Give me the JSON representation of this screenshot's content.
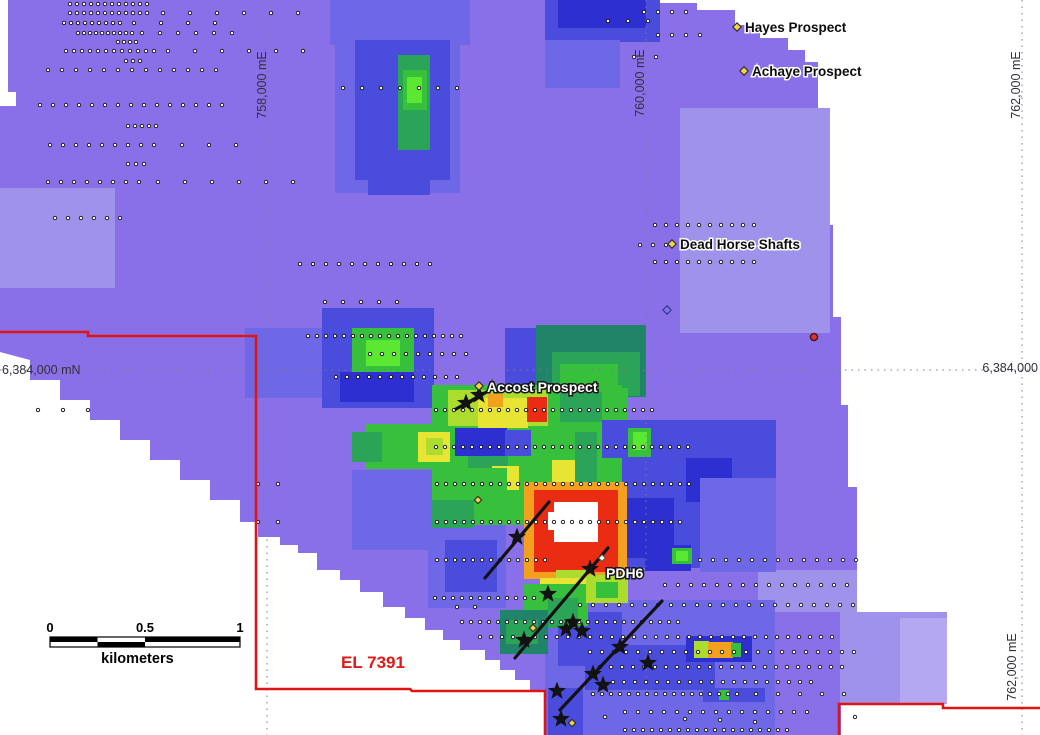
{
  "map": {
    "palette": {
      "base": "#8a70e8",
      "p1": "#9f92ea",
      "p2": "#b3a8f1",
      "lb": "#6f68e6",
      "b": "#4a4cdc",
      "db": "#2d2fd0",
      "nb": "#2324bc",
      "tl": "#1f8468",
      "tg": "#2ba458",
      "g": "#36c03c",
      "bg": "#5ce832",
      "yg": "#abdc2e",
      "y": "#e8e434",
      "o": "#f2a01e",
      "ro": "#f2641a",
      "r": "#ea2d12",
      "w": "#ffffff",
      "boundary": "#e11414",
      "gridline": "#7a7a8a",
      "star": "#121212",
      "marker_yellow": "#f2d545",
      "marker_outline": "#2a2a2a"
    },
    "surface_outline": "0,0 640,0 640,3 697,3 697,10 735,10 735,25 760,25 760,38 788,38 788,50 805,50 805,62 818,62 818,137 823,137 823,225 833,225 833,317 841,317 841,405 848,405 848,487 857,487 857,612 947,612 947,703 841,703 841,735 595,735 583,735 583,723 570,723 570,712 558,712 558,700 545,700 545,690 530,690 530,680 515,680 515,670 500,670 500,660 485,660 485,650 460,650 460,640 443,640 443,630 425,630 425,618 405,618 405,607 383,607 383,592 360,592 360,580 340,580 340,570 317,570 317,553 298,553 298,545 280,545 280,537 258,537 258,522 240,522 240,500 210,500 210,480 180,480 180,460 150,460 150,440 120,440 120,420 90,420 90,400 60,400 60,380 30,380 30,360 0,352",
    "heat_cells": [
      [
        0,
        0,
        8,
        98,
        "w"
      ],
      [
        0,
        92,
        16,
        14,
        "w"
      ],
      [
        680,
        108,
        150,
        225,
        "p1"
      ],
      [
        0,
        188,
        115,
        100,
        "p1"
      ],
      [
        758,
        570,
        99,
        42,
        "p1"
      ],
      [
        840,
        612,
        107,
        92,
        "p1"
      ],
      [
        900,
        618,
        47,
        86,
        "p2"
      ],
      [
        330,
        0,
        140,
        45,
        "lb"
      ],
      [
        335,
        25,
        125,
        168,
        "lb"
      ],
      [
        355,
        40,
        95,
        140,
        "b"
      ],
      [
        545,
        0,
        115,
        42,
        "b"
      ],
      [
        558,
        0,
        88,
        28,
        "db"
      ],
      [
        545,
        40,
        75,
        48,
        "lb"
      ],
      [
        398,
        55,
        32,
        118,
        "tg"
      ],
      [
        403,
        70,
        24,
        40,
        "g"
      ],
      [
        407,
        77,
        15,
        26,
        "bg"
      ],
      [
        368,
        150,
        62,
        45,
        "b"
      ],
      [
        245,
        328,
        85,
        70,
        "lb"
      ],
      [
        322,
        308,
        112,
        100,
        "b"
      ],
      [
        352,
        328,
        62,
        58,
        "g"
      ],
      [
        366,
        340,
        34,
        26,
        "bg"
      ],
      [
        340,
        372,
        74,
        30,
        "db"
      ],
      [
        505,
        328,
        48,
        64,
        "b"
      ],
      [
        536,
        325,
        110,
        72,
        "tl"
      ],
      [
        552,
        352,
        88,
        44,
        "tg"
      ],
      [
        560,
        364,
        58,
        26,
        "g"
      ],
      [
        596,
        420,
        180,
        148,
        "b"
      ],
      [
        610,
        498,
        64,
        60,
        "db"
      ],
      [
        686,
        458,
        46,
        44,
        "db"
      ],
      [
        645,
        545,
        46,
        26,
        "db"
      ],
      [
        700,
        478,
        76,
        94,
        "lb"
      ],
      [
        545,
        600,
        230,
        135,
        "lb"
      ],
      [
        558,
        612,
        64,
        54,
        "b"
      ],
      [
        585,
        645,
        130,
        45,
        "b"
      ],
      [
        548,
        688,
        35,
        47,
        "b"
      ],
      [
        686,
        636,
        66,
        26,
        "db"
      ],
      [
        703,
        688,
        62,
        14,
        "b"
      ],
      [
        352,
        470,
        80,
        80,
        "lb"
      ],
      [
        428,
        520,
        78,
        88,
        "lb"
      ],
      [
        445,
        540,
        52,
        52,
        "b"
      ],
      [
        432,
        385,
        190,
        140,
        "g"
      ],
      [
        448,
        390,
        100,
        36,
        "yg"
      ],
      [
        600,
        388,
        28,
        32,
        "g"
      ],
      [
        560,
        392,
        42,
        30,
        "tg"
      ],
      [
        478,
        398,
        50,
        30,
        "y"
      ],
      [
        488,
        394,
        15,
        13,
        "o"
      ],
      [
        527,
        397,
        20,
        25,
        "r"
      ],
      [
        365,
        424,
        80,
        45,
        "g"
      ],
      [
        352,
        432,
        30,
        30,
        "tg"
      ],
      [
        418,
        432,
        32,
        30,
        "y"
      ],
      [
        426,
        438,
        17,
        17,
        "yg"
      ],
      [
        455,
        428,
        52,
        28,
        "db"
      ],
      [
        505,
        430,
        26,
        26,
        "b"
      ],
      [
        468,
        456,
        40,
        20,
        "tg"
      ],
      [
        492,
        466,
        27,
        27,
        "y"
      ],
      [
        552,
        460,
        28,
        34,
        "y"
      ],
      [
        575,
        432,
        22,
        56,
        "tg"
      ],
      [
        602,
        420,
        22,
        38,
        "b"
      ],
      [
        628,
        428,
        23,
        29,
        "g"
      ],
      [
        633,
        432,
        14,
        18,
        "bg"
      ],
      [
        445,
        468,
        62,
        56,
        "g"
      ],
      [
        432,
        500,
        42,
        28,
        "tg"
      ],
      [
        500,
        490,
        62,
        32,
        "g"
      ],
      [
        672,
        548,
        20,
        16,
        "g"
      ],
      [
        676,
        551,
        12,
        10,
        "bg"
      ],
      [
        524,
        482,
        103,
        97,
        "o"
      ],
      [
        534,
        490,
        84,
        82,
        "r"
      ],
      [
        554,
        502,
        44,
        40,
        "w"
      ],
      [
        548,
        512,
        8,
        18,
        "w"
      ],
      [
        556,
        570,
        32,
        12,
        "yg"
      ],
      [
        540,
        578,
        52,
        16,
        "y"
      ],
      [
        524,
        584,
        64,
        42,
        "g"
      ],
      [
        586,
        575,
        42,
        28,
        "yg"
      ],
      [
        596,
        582,
        22,
        16,
        "g"
      ],
      [
        548,
        598,
        30,
        30,
        "tg"
      ],
      [
        500,
        610,
        48,
        44,
        "tl"
      ],
      [
        506,
        620,
        32,
        24,
        "tg"
      ],
      [
        694,
        641,
        15,
        17,
        "yg"
      ],
      [
        708,
        642,
        25,
        16,
        "o"
      ],
      [
        731,
        643,
        10,
        14,
        "g"
      ],
      [
        719,
        690,
        10,
        10,
        "g"
      ]
    ],
    "gridlines": {
      "verticals": [
        267,
        646,
        1022
      ],
      "horizontal": 370
    },
    "sample_rows": [
      {
        "y": 4,
        "segs": [
          [
            70,
            150,
            7
          ]
        ]
      },
      {
        "y": 13,
        "segs": [
          [
            70,
            150,
            7
          ],
          [
            163,
            312,
            27
          ]
        ]
      },
      {
        "y": 12,
        "segs": [
          [
            644,
            688,
            14
          ]
        ]
      },
      {
        "y": 23,
        "segs": [
          [
            64,
            122,
            7
          ],
          [
            134,
            218,
            27
          ]
        ]
      },
      {
        "y": 21,
        "segs": [
          [
            608,
            650,
            20
          ]
        ]
      },
      {
        "y": 33,
        "segs": [
          [
            78,
            132,
            6
          ],
          [
            142,
            232,
            18
          ]
        ]
      },
      {
        "y": 35,
        "segs": [
          [
            658,
            700,
            14
          ]
        ]
      },
      {
        "y": 42,
        "segs": [
          [
            118,
            139,
            6
          ]
        ]
      },
      {
        "y": 51,
        "segs": [
          [
            66,
            158,
            8
          ],
          [
            168,
            312,
            27
          ]
        ]
      },
      {
        "y": 57,
        "segs": [
          [
            634,
            658,
            22
          ]
        ]
      },
      {
        "y": 61,
        "segs": [
          [
            126,
            141,
            7
          ]
        ]
      },
      {
        "y": 70,
        "segs": [
          [
            48,
            217,
            14
          ]
        ]
      },
      {
        "y": 88,
        "segs": [
          [
            343,
            458,
            19
          ]
        ]
      },
      {
        "y": 105,
        "segs": [
          [
            40,
            224,
            13
          ]
        ]
      },
      {
        "y": 126,
        "segs": [
          [
            128,
            162,
            7
          ]
        ]
      },
      {
        "y": 145,
        "segs": [
          [
            50,
            163,
            13
          ],
          [
            182,
            262,
            27
          ]
        ]
      },
      {
        "y": 164,
        "segs": [
          [
            128,
            145,
            8
          ]
        ]
      },
      {
        "y": 182,
        "segs": [
          [
            48,
            146,
            13
          ],
          [
            158,
            310,
            27
          ]
        ]
      },
      {
        "y": 218,
        "segs": [
          [
            55,
            125,
            13
          ]
        ]
      },
      {
        "y": 225,
        "segs": [
          [
            655,
            757,
            11
          ]
        ]
      },
      {
        "y": 245,
        "segs": [
          [
            640,
            666,
            13
          ]
        ]
      },
      {
        "y": 262,
        "segs": [
          [
            655,
            762,
            11
          ]
        ]
      },
      {
        "y": 264,
        "segs": [
          [
            300,
            436,
            13
          ]
        ]
      },
      {
        "y": 302,
        "segs": [
          [
            325,
            397,
            18
          ]
        ]
      },
      {
        "y": 336,
        "segs": [
          [
            308,
            462,
            9
          ]
        ]
      },
      {
        "y": 354,
        "segs": [
          [
            370,
            470,
            12
          ]
        ]
      },
      {
        "y": 377,
        "segs": [
          [
            336,
            458,
            11
          ]
        ]
      },
      {
        "y": 410,
        "segs": [
          [
            38,
            112,
            25
          ],
          [
            436,
            660,
            9
          ]
        ]
      },
      {
        "y": 447,
        "segs": [
          [
            436,
            690,
            9
          ]
        ]
      },
      {
        "y": 484,
        "segs": [
          [
            258,
            282,
            20
          ],
          [
            437,
            690,
            9
          ]
        ]
      },
      {
        "y": 522,
        "segs": [
          [
            258,
            282,
            20
          ],
          [
            437,
            688,
            9
          ]
        ]
      },
      {
        "y": 560,
        "segs": [
          [
            437,
            545,
            9
          ],
          [
            700,
            858,
            13
          ]
        ]
      },
      {
        "y": 585,
        "segs": [
          [
            665,
            858,
            13
          ]
        ]
      },
      {
        "y": 598,
        "segs": [
          [
            435,
            540,
            9
          ]
        ]
      },
      {
        "y": 605,
        "segs": [
          [
            580,
            858,
            13
          ]
        ]
      },
      {
        "y": 622,
        "segs": [
          [
            462,
            680,
            9
          ]
        ]
      },
      {
        "y": 637,
        "segs": [
          [
            480,
            840,
            11
          ]
        ]
      },
      {
        "y": 652,
        "segs": [
          [
            590,
            860,
            12
          ]
        ]
      },
      {
        "y": 667,
        "segs": [
          [
            600,
            850,
            11
          ]
        ]
      },
      {
        "y": 682,
        "segs": [
          [
            613,
            816,
            11
          ]
        ]
      },
      {
        "y": 694,
        "segs": [
          [
            593,
            745,
            9
          ],
          [
            756,
            845,
            22
          ]
        ]
      },
      {
        "y": 712,
        "segs": [
          [
            625,
            810,
            13
          ]
        ]
      },
      {
        "y": 730,
        "segs": [
          [
            625,
            790,
            9
          ]
        ]
      }
    ],
    "extra_dots": [
      [
        457,
        607
      ],
      [
        475,
        607
      ],
      [
        605,
        717
      ],
      [
        685,
        719
      ],
      [
        720,
        720
      ],
      [
        755,
        722
      ],
      [
        855,
        717
      ]
    ],
    "stars": [
      [
        466,
        403
      ],
      [
        479,
        395
      ],
      [
        517,
        537
      ],
      [
        590,
        569
      ],
      [
        548,
        594
      ],
      [
        573,
        622
      ],
      [
        582,
        631
      ],
      [
        566,
        629
      ],
      [
        524,
        640
      ],
      [
        620,
        647
      ],
      [
        648,
        663
      ],
      [
        593,
        674
      ],
      [
        603,
        685
      ],
      [
        557,
        691
      ],
      [
        561,
        719
      ]
    ],
    "drill_lines": [
      [
        456,
        409,
        492,
        389
      ],
      [
        485,
        578,
        549,
        502
      ],
      [
        515,
        658,
        608,
        548
      ],
      [
        560,
        710,
        662,
        601
      ]
    ],
    "boundary_paths": [
      "M 0,332 L 88,332 L 88,336 L 256,336 L 256,689 L 410,689 L 412,691 L 545,691 L 545,735",
      "M 839,735 L 839,704 L 943,704 L 943,708 L 1040,708"
    ],
    "prospect_markers": [
      [
        737,
        27
      ],
      [
        744,
        71
      ],
      [
        672,
        244
      ],
      [
        479,
        386
      ]
    ],
    "small_diamonds": [
      [
        478,
        500
      ],
      [
        533,
        628
      ],
      [
        572,
        723
      ]
    ],
    "white_diamond": [
      602,
      558
    ],
    "red_circle": [
      814,
      337
    ],
    "outline_diamond": [
      667,
      310
    ],
    "labels": {
      "hayes": {
        "text": "Hayes Prospect",
        "x": 745,
        "y": 32,
        "style": "dark"
      },
      "achaye": {
        "text": "Achaye Prospect",
        "x": 752,
        "y": 76,
        "style": "dark"
      },
      "dead_horse": {
        "text": "Dead Horse Shafts",
        "x": 680,
        "y": 249,
        "style": "dark"
      },
      "accost": {
        "text": "Accost Prospect",
        "x": 487,
        "y": 392,
        "style": "light"
      },
      "pdh6": {
        "text": "PDH6",
        "x": 606,
        "y": 578,
        "style": "light"
      },
      "tenement": {
        "text": "EL 7391",
        "x": 341,
        "y": 668,
        "style": "tenement"
      }
    },
    "grid_labels": [
      {
        "text": "758,000 mE",
        "x": 266,
        "y": 85,
        "rotate": true,
        "anchor": "middle"
      },
      {
        "text": "760,000 mE",
        "x": 644,
        "y": 83,
        "rotate": true,
        "anchor": "middle"
      },
      {
        "text": "762,000 mE",
        "x": 1020,
        "y": 85,
        "rotate": true,
        "anchor": "middle"
      },
      {
        "text": "762,000 mE",
        "x": 1016,
        "y": 667,
        "rotate": true,
        "anchor": "middle"
      },
      {
        "text": "6,384,000 mN",
        "x": 2,
        "y": 374,
        "rotate": false,
        "anchor": "start"
      },
      {
        "text": "6,384,000",
        "x": 1038,
        "y": 372,
        "rotate": false,
        "anchor": "end"
      }
    ],
    "scalebar": {
      "x": 50,
      "y": 637,
      "width": 190,
      "height": 10,
      "ticks": [
        "0",
        "0.5",
        "1"
      ],
      "units": "kilometers"
    }
  }
}
